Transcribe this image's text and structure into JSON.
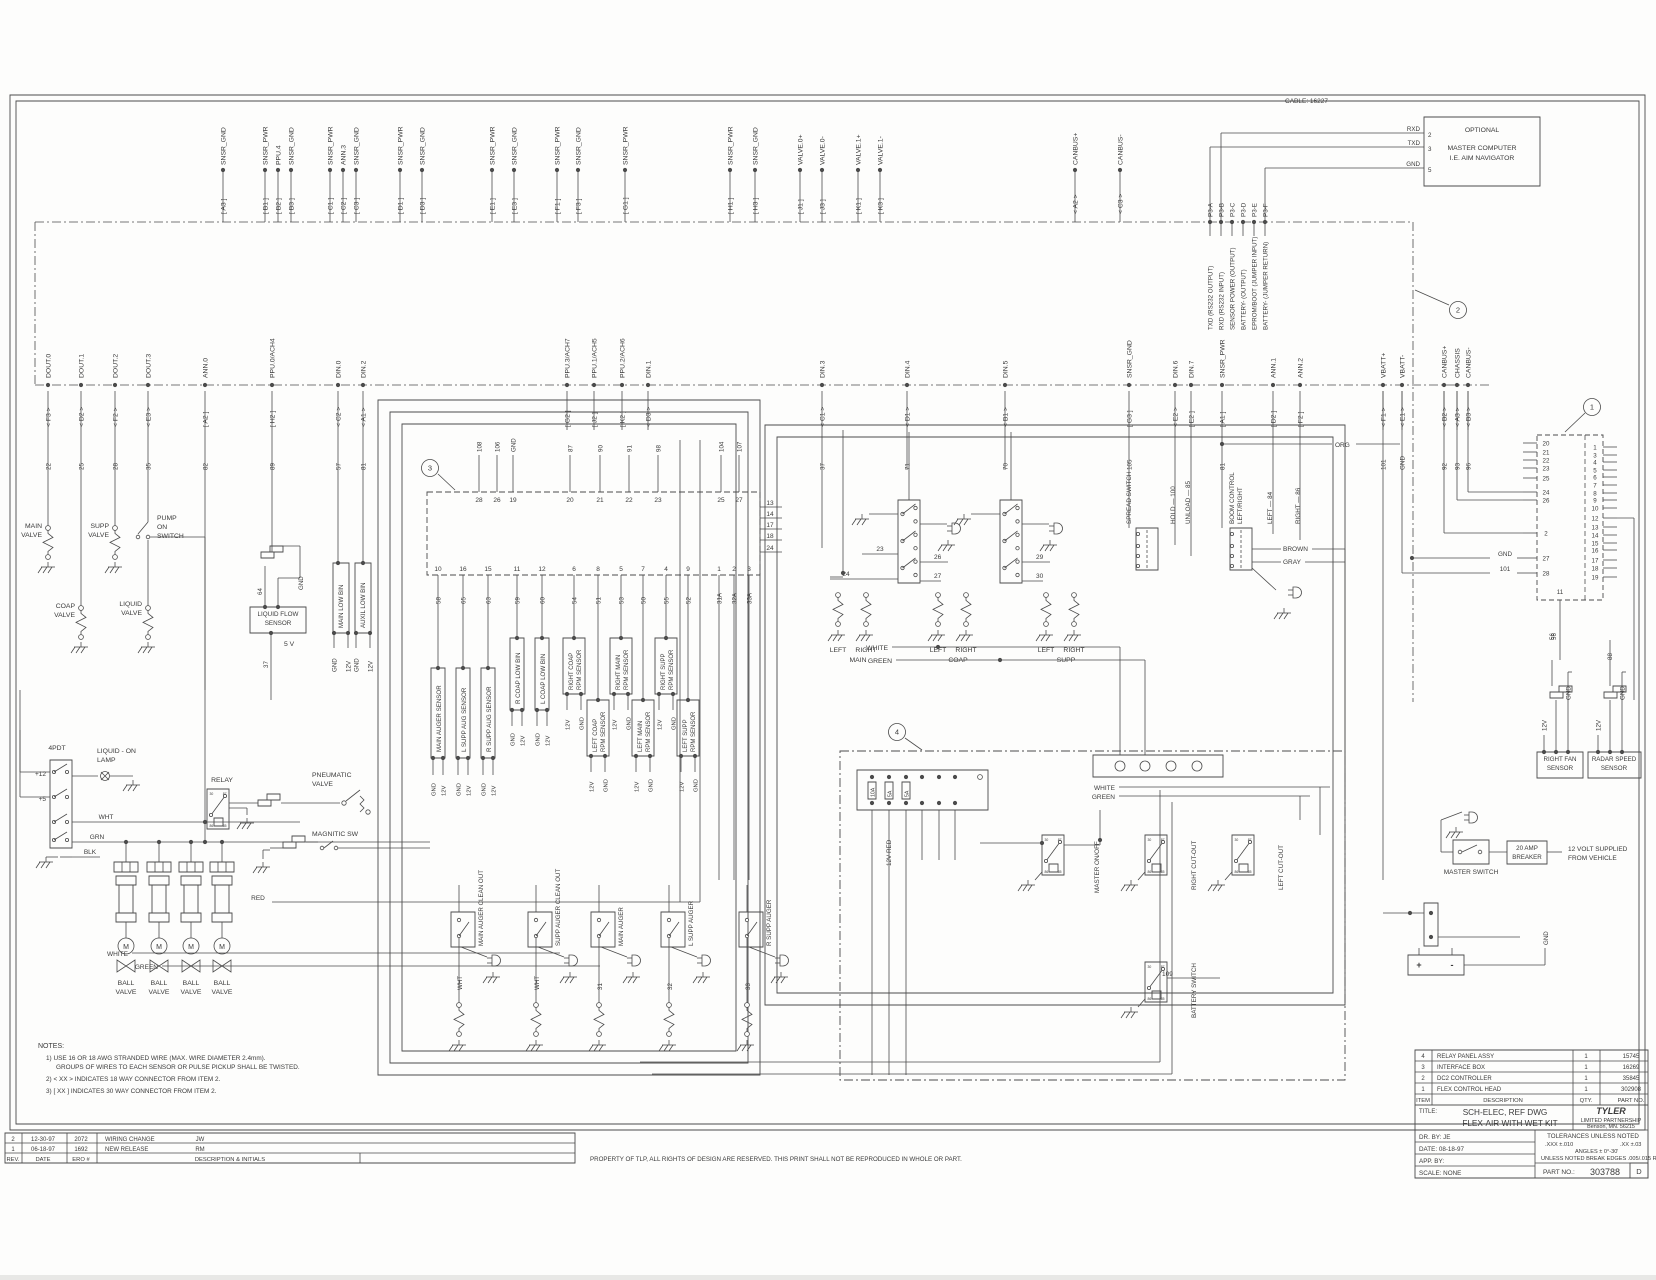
{
  "sheet": {
    "cable_note": "CABLE: 16227",
    "callouts": [
      "1",
      "2",
      "3",
      "4"
    ]
  },
  "master_computer": {
    "box_lines": [
      "OPTIONAL",
      "MASTER COMPUTER",
      "I.E. AIM NAVIGATOR"
    ],
    "pins": [
      {
        "num": "2",
        "sig": "RXD"
      },
      {
        "num": "3",
        "sig": "TXD"
      },
      {
        "num": "5",
        "sig": "GND"
      }
    ],
    "p3_labels": [
      "P3-A",
      "P3-B",
      "P3-C",
      "P3-D",
      "P3-E",
      "P3-F"
    ],
    "p3_desc": [
      "TXD (RS232 OUTPUT)",
      "RXD (RS232 INPUT)",
      "SENSOR POWER (OUTPUT)",
      "BATTERY- (OUTPUT)",
      "EPROM/BOOT (JUMPER INPUT)",
      "BATTERY- (JUMPER RETURN)"
    ]
  },
  "top_connectors": [
    {
      "tag": "[ A3 ]",
      "label": "SNSR_GND"
    },
    {
      "tag": "[ B1 ]",
      "label": "SNSR_PWR"
    },
    {
      "tag": "[ B2 ]",
      "label": "PPU.4"
    },
    {
      "tag": "[ B3 ]",
      "label": "SNSR_GND"
    },
    {
      "tag": "[ C1 ]",
      "label": "SNSR_PWR"
    },
    {
      "tag": "[ C2 ]",
      "label": "ANN.3"
    },
    {
      "tag": "[ C3 ]",
      "label": "SNSR_GND"
    },
    {
      "tag": "[ D1 ]",
      "label": "SNSR_PWR"
    },
    {
      "tag": "[ D3 ]",
      "label": "SNSR_GND"
    },
    {
      "tag": "[ E1 ]",
      "label": "SNSR_PWR"
    },
    {
      "tag": "[ E3 ]",
      "label": "SNSR_GND"
    },
    {
      "tag": "[ F1 ]",
      "label": "SNSR_PWR"
    },
    {
      "tag": "[ F3 ]",
      "label": "SNSR_GND"
    },
    {
      "tag": "[ G1 ]",
      "label": "SNSR_PWR"
    },
    {
      "tag": "[ H1 ]",
      "label": "SNSR_PWR"
    },
    {
      "tag": "[ H3 ]",
      "label": "SNSR_GND"
    },
    {
      "tag": "[ J1 ]",
      "label": "VALVE.0+"
    },
    {
      "tag": "[ J3 ]",
      "label": "VALVE.0-"
    },
    {
      "tag": "[ K1 ]",
      "label": "VALVE.1+"
    },
    {
      "tag": "[ K3 ]",
      "label": "VALVE.1-"
    },
    {
      "tag": "< A2 >",
      "label": "CANBUS+"
    },
    {
      "tag": "< C3 >",
      "label": "CANBUS-"
    }
  ],
  "bus2_taps": [
    {
      "tag": "< F3 >",
      "label": "DOUT.0",
      "wire": "22"
    },
    {
      "tag": "< D2 >",
      "label": "DOUT.1",
      "wire": "25"
    },
    {
      "tag": "< F2 >",
      "label": "DOUT.2",
      "wire": "28"
    },
    {
      "tag": "< E3 >",
      "label": "DOUT.3",
      "wire": "35"
    },
    {
      "tag": "[ A2 ]",
      "label": "ANN.0",
      "wire": "82"
    },
    {
      "tag": "[ H2 ]",
      "label": "PPU.0/ACH4",
      "wire": "89"
    },
    {
      "tag": "< C2 >",
      "label": "DIN.0",
      "wire": "57"
    },
    {
      "tag": "< A1 >",
      "label": "DIN.2",
      "wire": "81"
    },
    {
      "tag": "[ G2 ]",
      "label": "PPU.3/ACH7",
      "wire": ""
    },
    {
      "tag": "[ J2 ]",
      "label": "PPU.1/ACH5",
      "wire": ""
    },
    {
      "tag": "[ K2 ]",
      "label": "PPU.2/ACH6",
      "wire": ""
    },
    {
      "tag": "< D3 >",
      "label": "DIN.1",
      "wire": ""
    },
    {
      "tag": "< C1 >",
      "label": "DIN.3",
      "wire": "37"
    },
    {
      "tag": "< D1 >",
      "label": "DIN.4",
      "wire": "71"
    },
    {
      "tag": "< B1 >",
      "label": "DIN.5",
      "wire": "70"
    },
    {
      "tag": "[ G3 ]",
      "label": "SNSR_GND",
      "wire": "105"
    },
    {
      "tag": "< E2 >",
      "label": "DIN.6",
      "wire": ""
    },
    {
      "tag": "[ E2 ]",
      "label": "DIN.7",
      "wire": ""
    },
    {
      "tag": "[ A1 ]",
      "label": "SNSR_PWR",
      "wire": "81"
    },
    {
      "tag": "[ D2 ]",
      "label": "ANN.1",
      "wire": ""
    },
    {
      "tag": "[ F2 ]",
      "label": "ANN.2",
      "wire": ""
    },
    {
      "tag": "< F1 >",
      "label": "VBATT+",
      "wire": "101"
    },
    {
      "tag": "< E1 >",
      "label": "VBATT-",
      "wire": "GND"
    },
    {
      "tag": "< B2 >",
      "label": "CANBUS+",
      "wire": "92"
    },
    {
      "tag": "< A3 >",
      "label": "CHASSIS",
      "wire": "93"
    },
    {
      "tag": "< B3 >",
      "label": "CANBUS-",
      "wire": "96"
    }
  ],
  "left_components": {
    "main_valve": [
      "MAIN",
      "VALVE"
    ],
    "supp_valve": [
      "SUPP",
      "VALVE"
    ],
    "pump_switch": [
      "PUMP",
      "ON",
      "SWITCH"
    ],
    "coap_valve": [
      "COAP",
      "VALVE"
    ],
    "liquid_valve": [
      "LIQUID",
      "VALVE"
    ],
    "flow_sensor": [
      "LIQUID FLOW",
      "SENSOR"
    ],
    "five_v": "5 V",
    "wire_37": "37",
    "wire_64": "64",
    "gnd": "GND",
    "main_low_bin": "MAIN LOW BIN",
    "auxil_low_bin": "AUXIL LOW BIN",
    "bin_pins": [
      "GND",
      "12V",
      "GND",
      "12V"
    ]
  },
  "controller": {
    "top_pins": [
      "28",
      "26",
      "19",
      "20",
      "21",
      "22",
      "23",
      "25",
      "27"
    ],
    "top_wires": [
      "108",
      "106",
      "GND",
      "87",
      "90",
      "91",
      "98",
      "104",
      "107"
    ],
    "right_pins": [
      "13",
      "14",
      "17",
      "18",
      "24"
    ],
    "bottom_pins": [
      "10",
      "16",
      "15",
      "11",
      "12",
      "6",
      "8",
      "5",
      "7",
      "4",
      "9",
      "1",
      "2",
      "3"
    ],
    "bottom_wires": [
      "58",
      "65",
      "63",
      "59",
      "60",
      "54",
      "51",
      "53",
      "50",
      "55",
      "52",
      "31A",
      "32A",
      "33A"
    ],
    "aug_sensors": [
      "MAIN AUGER SENSOR",
      "L SUPP AUG SENSOR",
      "R SUPP AUG SENSOR"
    ],
    "bin_sensors": [
      "R COAP LOW BIN",
      "L COAP LOW BIN"
    ],
    "rpm_sensors": [
      [
        "RIGHT COAP",
        "RPM SENSOR"
      ],
      [
        "LEFT COAP",
        "RPM SENSOR"
      ],
      [
        "RIGHT MAIN",
        "RPM SENSOR"
      ],
      [
        "LEFT MAIN",
        "RPM SENSOR"
      ],
      [
        "RIGHT SUPP",
        "RPM SENSOR"
      ],
      [
        "LEFT SUPP",
        "RPM SENSOR"
      ]
    ],
    "lead_labels": [
      "GND",
      "12V"
    ]
  },
  "switch_groups": {
    "pair_labels": [
      [
        "LEFT",
        "RIGHT",
        "MAIN"
      ],
      [
        "LEFT",
        "RIGHT",
        "COAP"
      ],
      [
        "LEFT",
        "RIGHT",
        "SUPP"
      ]
    ],
    "wires": [
      "23",
      "24",
      "26",
      "27",
      "29",
      "30"
    ],
    "white": "WHITE",
    "green": "GREEN"
  },
  "spread_switch": {
    "label": "SPREAD SWITCH",
    "wire": "105",
    "hold": "HOLD — 100",
    "unload": "UNLOAD — 85"
  },
  "boom_control": {
    "label1": "BOOM CONTROL",
    "label2": "LEFT/RIGHT",
    "left": "LEFT — 84",
    "right": "RIGHT — 86",
    "brown": "BROWN",
    "gray": "GRAY",
    "org": "ORG"
  },
  "right_connector": {
    "left_pins": [
      "20",
      "21",
      "22",
      "23",
      "25",
      "24",
      "26",
      "2",
      "27",
      "28"
    ],
    "pin11": "11",
    "right_pins": [
      "1",
      "3",
      "4",
      "5",
      "6",
      "7",
      "8",
      "9",
      "10",
      "12",
      "13",
      "14",
      "15",
      "16",
      "17",
      "18",
      "19"
    ],
    "gnd": "GND",
    "w101": "101",
    "w56": "56"
  },
  "relay_panel": {
    "fuses": [
      "10A",
      "5A",
      "5A"
    ],
    "red12": "12V RED",
    "white": "WHITE",
    "green": "GREEN",
    "relay_master": "MASTER ON/OFF",
    "relay_right": "RIGHT CUT-OUT",
    "relay_left": "LEFT CUT-OUT",
    "relay_batt": "BATTERY SWITCH",
    "wire109": "109"
  },
  "bottom_left": {
    "four_pdt": "4PDT",
    "plus12": "+12",
    "plus5": "+5",
    "lamp1": "LIQUID - ON",
    "lamp2": "LAMP",
    "relay": "RELAY",
    "pneu1": "PNEUMATIC",
    "pneu2": "VALVE",
    "magnetic": "MAGNITIC SW",
    "wht": "WHT",
    "grn": "GRN",
    "blk": "BLK",
    "red": "RED",
    "ball1": "BALL",
    "ball2": "VALVE",
    "motor": "M",
    "white": "WHITE",
    "green": "GREEN"
  },
  "augers": {
    "items": [
      "MAIN AUGER CLEAN OUT",
      "SUPP AUGER CLEAN OUT",
      "MAIN AUGER",
      "L SUPP AUGER",
      "R SUPP AUGER"
    ],
    "wires": [
      "WHT",
      "WHT",
      "31",
      "32",
      "33"
    ]
  },
  "bottom_right": {
    "fan_sensor": [
      "RIGHT FAN",
      "SENSOR"
    ],
    "radar_sensor": [
      "RADAR SPEED",
      "SENSOR"
    ],
    "v12": "12V",
    "gnd": "GND",
    "w88": "88",
    "w56": "56",
    "master_switch": "MASTER SWITCH",
    "breaker": [
      "20 AMP",
      "BREAKER"
    ],
    "supply": [
      "12 VOLT SUPPLIED",
      "FROM VEHICLE"
    ],
    "plus": "+",
    "minus": "-"
  },
  "notes": {
    "title": "NOTES:",
    "l1": "1) USE 16 OR 18 AWG STRANDED WIRE (MAX. WIRE DIAMETER 2.4mm).",
    "l2": "GROUPS OF WIRES TO EACH SENSOR OR PULSE PICKUP SHALL BE TWISTED.",
    "l3": "2) < XX > INDICATES 18 WAY CONNECTOR FROM ITEM 2.",
    "l4": "3) [ XX ] INDICATES 30 WAY CONNECTOR FROM ITEM 2."
  },
  "revisions": {
    "header": [
      "REV.",
      "DATE",
      "ERO #",
      "DESCRIPTION & INITIALS"
    ],
    "rows": [
      [
        "2",
        "12-30-97",
        "2072",
        "WIRING CHANGE",
        "JW"
      ],
      [
        "1",
        "06-18-97",
        "1692",
        "NEW RELEASE",
        "RM"
      ]
    ],
    "property": "PROPERTY OF TLP, ALL RIGHTS OF DESIGN ARE RESERVED. THIS PRINT SHALL NOT BE REPRODUCED IN WHOLE OR PART."
  },
  "title_block": {
    "parts_header": [
      "ITEM",
      "DESCRIPTION",
      "QTY.",
      "PART NO."
    ],
    "parts": [
      [
        "4",
        "RELAY PANEL ASSY",
        "1",
        "15745"
      ],
      [
        "3",
        "INTERFACE BOX",
        "1",
        "16269"
      ],
      [
        "2",
        "DC2 CONTROLLER",
        "1",
        "35845"
      ],
      [
        "1",
        "FLEX CONTROL HEAD",
        "1",
        "302908"
      ]
    ],
    "title_label": "TITLE:",
    "title1": "SCH-ELEC, REF DWG",
    "title2": "FLEX-AIR WITH WET KIT",
    "company": "TYLER",
    "company2": "LIMITED PARTNERSHIP",
    "company3": "Benson, MN. 56215",
    "dr_by": "DR. BY: JE",
    "date": "DATE: 08-18-97",
    "app_by": "APP. BY:",
    "scale": "SCALE: NONE",
    "tol_title": "TOLERANCES UNLESS NOTED",
    "tol1": ".XXX  ±.010",
    "tol2": ".XX  ±.03",
    "tol3": "ANGLES ± 0°-30'",
    "tol4": "UNLESS NOTED BREAK EDGES .005/.015 R.",
    "part_no_label": "PART NO.:",
    "part_no": "303788",
    "size": "D"
  }
}
